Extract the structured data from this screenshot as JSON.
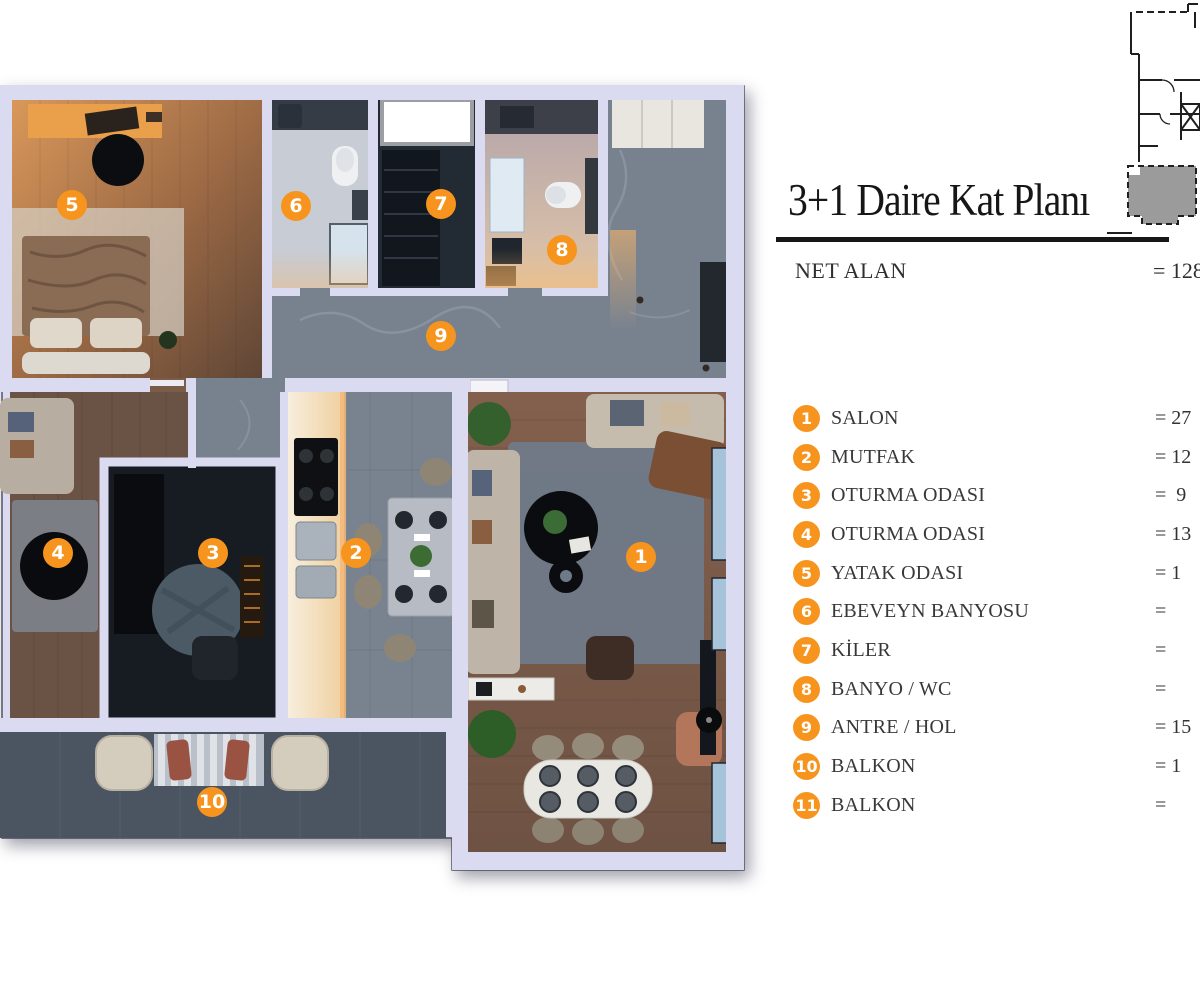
{
  "title": "3+1 Daire Kat Planı",
  "net_alan": {
    "label": "NET ALAN",
    "value": "= 128"
  },
  "legend": [
    {
      "num": "1",
      "label": "SALON",
      "value": "= 27"
    },
    {
      "num": "2",
      "label": "MUTFAK",
      "value": "= 12"
    },
    {
      "num": "3",
      "label": "OTURMA ODASI",
      "value": "=  9"
    },
    {
      "num": "4",
      "label": "OTURMA ODASI",
      "value": "= 13"
    },
    {
      "num": "5",
      "label": "YATAK ODASI",
      "value": "= 1"
    },
    {
      "num": "6",
      "label": "EBEVEYN BANYOSU",
      "value": "="
    },
    {
      "num": "7",
      "label": "KİLER",
      "value": "="
    },
    {
      "num": "8",
      "label": "BANYO / WC",
      "value": "="
    },
    {
      "num": "9",
      "label": "ANTRE / HOL",
      "value": "= 15"
    },
    {
      "num": "10",
      "label": "BALKON",
      "value": "= 1"
    },
    {
      "num": "11",
      "label": "BALKON",
      "value": "="
    }
  ],
  "plan_markers": [
    {
      "num": "1",
      "x": 641,
      "y": 557
    },
    {
      "num": "2",
      "x": 356,
      "y": 553
    },
    {
      "num": "3",
      "x": 213,
      "y": 553
    },
    {
      "num": "4",
      "x": 58,
      "y": 553
    },
    {
      "num": "5",
      "x": 72,
      "y": 205
    },
    {
      "num": "6",
      "x": 296,
      "y": 206
    },
    {
      "num": "7",
      "x": 441,
      "y": 204
    },
    {
      "num": "8",
      "x": 562,
      "y": 250
    },
    {
      "num": "9",
      "x": 441,
      "y": 336
    },
    {
      "num": "10",
      "x": 212,
      "y": 802
    }
  ],
  "colors": {
    "accent_orange": "#F7941D",
    "wall": "#DADBF0",
    "keyplan_unit": "#9B9B9B",
    "title_text": "#161616",
    "legend_text": "#383838"
  }
}
